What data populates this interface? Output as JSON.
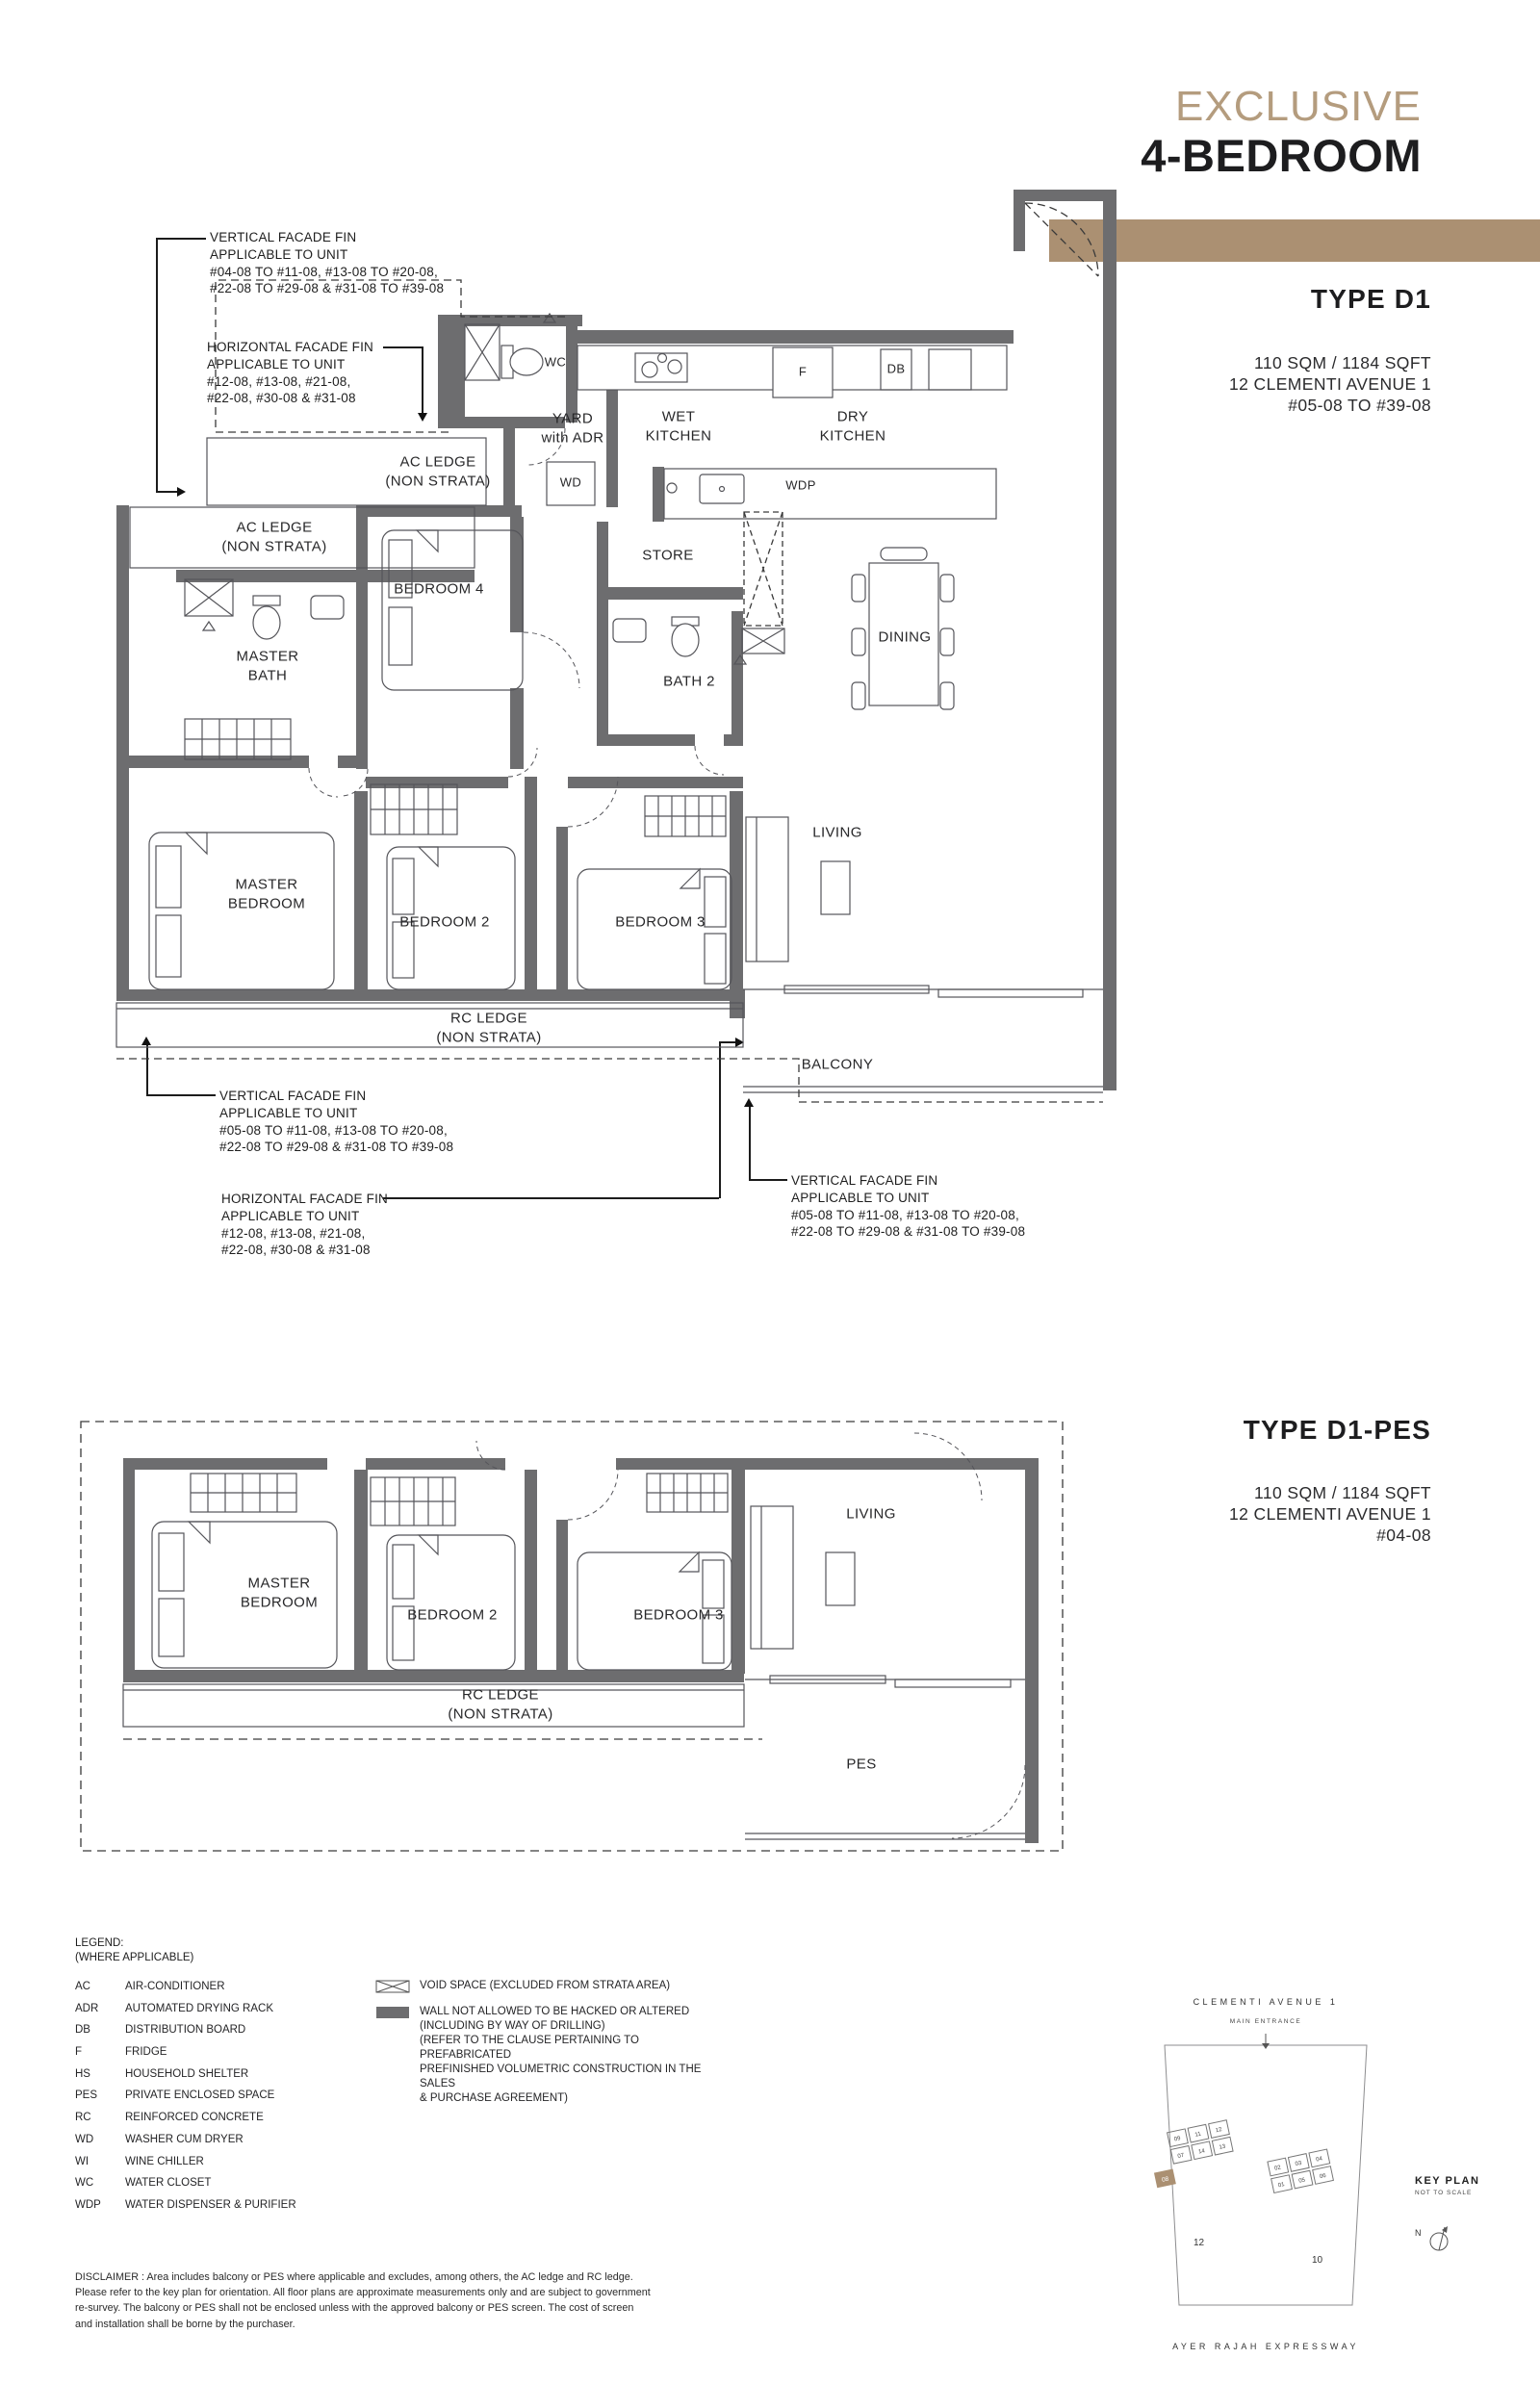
{
  "header": {
    "kicker": "EXCLUSIVE",
    "title": "4-BEDROOM",
    "accent_color": "#ab9072"
  },
  "type_d1": {
    "name": "TYPE D1",
    "info": "110 SQM / 1184 SQFT\n12 CLEMENTI AVENUE 1\n#05-08 TO #39-08"
  },
  "type_d1_pes": {
    "name": "TYPE D1-PES",
    "info": "110 SQM / 1184 SQFT\n12 CLEMENTI AVENUE 1\n#04-08"
  },
  "annotations": {
    "top_vertical_fin": "VERTICAL FACADE FIN\nAPPLICABLE TO UNIT\n#04-08 TO #11-08, #13-08 TO #20-08,\n#22-08 TO #29-08 & #31-08 TO #39-08",
    "top_horizontal_fin": "HORIZONTAL FACADE FIN\nAPPLICABLE TO UNIT\n#12-08, #13-08, #21-08,\n#22-08, #30-08 & #31-08",
    "bottom_vertical_fin_left": "VERTICAL FACADE FIN\nAPPLICABLE TO UNIT\n#05-08 TO #11-08, #13-08 TO #20-08,\n#22-08 TO #29-08 & #31-08 TO #39-08",
    "bottom_horizontal_fin": "HORIZONTAL FACADE FIN\nAPPLICABLE TO UNIT\n#12-08, #13-08, #21-08,\n#22-08, #30-08 & #31-08",
    "bottom_vertical_fin_right": "VERTICAL FACADE FIN\nAPPLICABLE TO UNIT\n#05-08 TO #11-08, #13-08 TO #20-08,\n#22-08 TO #29-08 & #31-08 TO #39-08"
  },
  "plan_d1": {
    "rooms": {
      "wc": "WC",
      "yard": "YARD\nwith ADR",
      "wet_kitchen": "WET\nKITCHEN",
      "dry_kitchen": "DRY\nKITCHEN",
      "fridge": "F",
      "db": "DB",
      "wd": "WD",
      "wdp": "WDP",
      "ac_ledge_top": "AC LEDGE\n(NON STRATA)",
      "ac_ledge_left": "AC LEDGE\n(NON STRATA)",
      "store": "STORE",
      "bath_2": "BATH 2",
      "dining": "DINING",
      "master_bath": "MASTER\nBATH",
      "bedroom_4": "BEDROOM 4",
      "master_bedroom": "MASTER\nBEDROOM",
      "bedroom_2": "BEDROOM 2",
      "bedroom_3": "BEDROOM 3",
      "living": "LIVING",
      "balcony": "BALCONY",
      "rc_ledge": "RC LEDGE\n(NON STRATA)"
    }
  },
  "plan_d1_pes": {
    "rooms": {
      "master_bedroom": "MASTER\nBEDROOM",
      "bedroom_2": "BEDROOM 2",
      "bedroom_3": "BEDROOM 3",
      "living": "LIVING",
      "pes": "PES",
      "rc_ledge": "RC LEDGE\n(NON STRATA)"
    }
  },
  "legend": {
    "title": "LEGEND:\n(WHERE APPLICABLE)",
    "items": [
      {
        "abbr": "AC",
        "label": "AIR-CONDITIONER"
      },
      {
        "abbr": "ADR",
        "label": "AUTOMATED DRYING RACK"
      },
      {
        "abbr": "DB",
        "label": "DISTRIBUTION BOARD"
      },
      {
        "abbr": "F",
        "label": "FRIDGE"
      },
      {
        "abbr": "HS",
        "label": "HOUSEHOLD SHELTER"
      },
      {
        "abbr": "PES",
        "label": "PRIVATE ENCLOSED SPACE"
      },
      {
        "abbr": "RC",
        "label": "REINFORCED CONCRETE"
      },
      {
        "abbr": "WD",
        "label": "WASHER CUM DRYER"
      },
      {
        "abbr": "WI",
        "label": "WINE CHILLER"
      },
      {
        "abbr": "WC",
        "label": "WATER CLOSET"
      },
      {
        "abbr": "WDP",
        "label": "WATER DISPENSER & PURIFIER"
      }
    ],
    "void_space": "VOID SPACE (EXCLUDED FROM STRATA AREA)",
    "wall_note": "WALL NOT ALLOWED TO BE HACKED OR ALTERED\n(INCLUDING BY WAY OF DRILLING)\n(REFER TO THE CLAUSE PERTAINING TO PREFABRICATED\nPREFINISHED VOLUMETRIC CONSTRUCTION IN THE SALES\n& PURCHASE AGREEMENT)",
    "wall_color": "#6d6d6f"
  },
  "disclaimer": "DISCLAIMER : Area includes balcony or PES where applicable and excludes, among others, the AC ledge and RC ledge. Please refer to the key plan for orientation. All floor plans are approximate measurements only and are subject to government re-survey. The balcony or PES shall not be enclosed unless with the approved balcony or PES screen. The cost of screen and installation shall be borne by the purchaser.",
  "key_plan": {
    "road_top": "CLEMENTI  AVENUE  1",
    "main_entrance": "MAIN  ENTRANCE",
    "label": "KEY PLAN",
    "scale_note": "NOT TO SCALE",
    "north": "N",
    "block12_label": "12",
    "block10_label": "10",
    "highlight_unit": "08",
    "highlight_color": "#ab9072",
    "block12_units": [
      "09",
      "11",
      "12",
      "07",
      "14",
      "13"
    ],
    "block10_units": [
      "02",
      "03",
      "04",
      "01",
      "05",
      "06"
    ],
    "road_bottom": "AYER  RAJAH  EXPRESSWAY"
  }
}
